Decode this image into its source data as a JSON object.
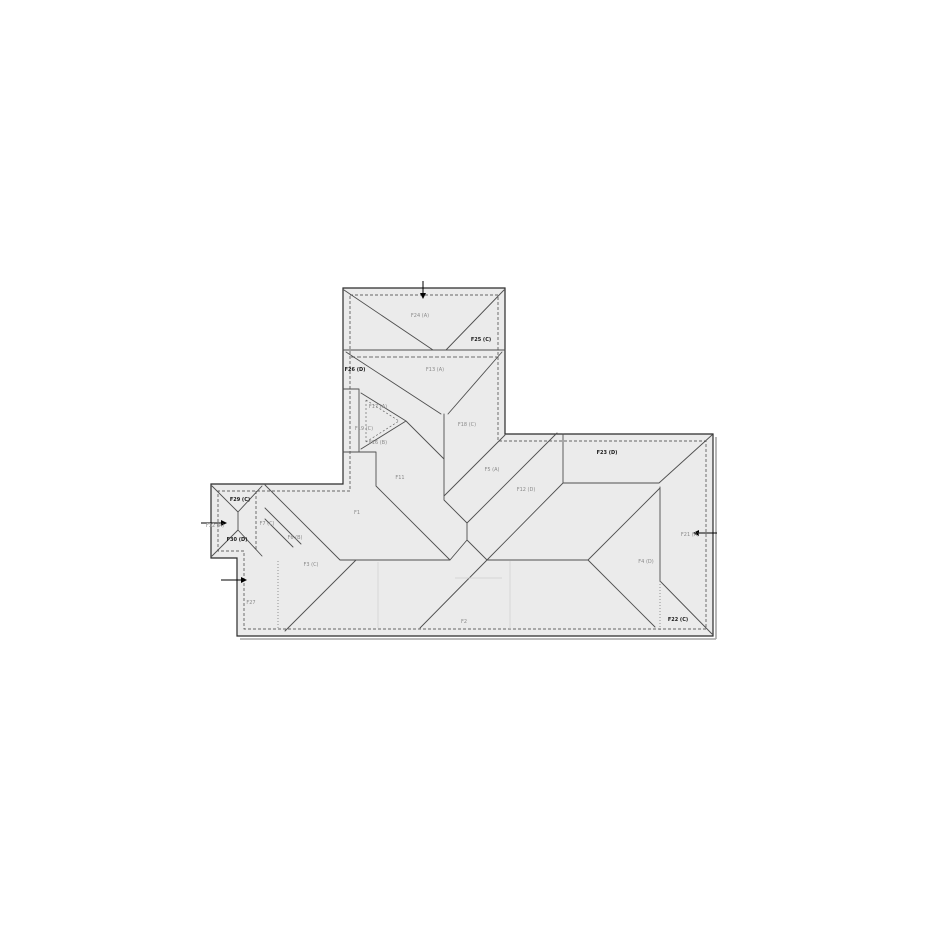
{
  "page": {
    "background": "#ffffff",
    "title": "roof-plan-drawing"
  },
  "drawing": {
    "kind": "roof plan",
    "colors": {
      "roof_fill": "#ebebeb",
      "outline": "#2b2b2b",
      "label_gray": "#8a8a8a",
      "label_bold": "#1a1a1a",
      "arrow": "#000000"
    },
    "labels": [
      {
        "id": "F24",
        "text": "F24 (A)",
        "x": 420,
        "y": 317,
        "bold": false
      },
      {
        "id": "F25",
        "text": "F25 (C)",
        "x": 481,
        "y": 341,
        "bold": true
      },
      {
        "id": "F26",
        "text": "F26 (D)",
        "x": 355,
        "y": 371,
        "bold": true
      },
      {
        "id": "F13",
        "text": "F13 (A)",
        "x": 435,
        "y": 371,
        "bold": false
      },
      {
        "id": "F17",
        "text": "F17 (A)",
        "x": 378,
        "y": 408,
        "bold": false
      },
      {
        "id": "F19",
        "text": "F19 (C)",
        "x": 364,
        "y": 430,
        "bold": false
      },
      {
        "id": "F16",
        "text": "F16 (B)",
        "x": 378,
        "y": 444,
        "bold": false
      },
      {
        "id": "F18",
        "text": "F18 (C)",
        "x": 467,
        "y": 426,
        "bold": false
      },
      {
        "id": "F11",
        "text": "F11",
        "x": 400,
        "y": 479,
        "bold": false
      },
      {
        "id": "F5",
        "text": "F5 (A)",
        "x": 492,
        "y": 471,
        "bold": false
      },
      {
        "id": "F12",
        "text": "F12 (D)",
        "x": 526,
        "y": 491,
        "bold": false
      },
      {
        "id": "F23",
        "text": "F23 (D)",
        "x": 607,
        "y": 454,
        "bold": true
      },
      {
        "id": "F21",
        "text": "F21 (A)",
        "x": 690,
        "y": 536,
        "bold": false
      },
      {
        "id": "F4",
        "text": "F4 (D)",
        "x": 646,
        "y": 563,
        "bold": false
      },
      {
        "id": "F22",
        "text": "F22 (C)",
        "x": 678,
        "y": 621,
        "bold": true
      },
      {
        "id": "F2",
        "text": "F2",
        "x": 464,
        "y": 623,
        "bold": false
      },
      {
        "id": "F3",
        "text": "F3 (C)",
        "x": 311,
        "y": 566,
        "bold": false
      },
      {
        "id": "F1",
        "text": "F1",
        "x": 357,
        "y": 514,
        "bold": false
      },
      {
        "id": "F7",
        "text": "F7 (C)",
        "x": 267,
        "y": 525,
        "bold": false
      },
      {
        "id": "F6",
        "text": "F6 (B)",
        "x": 295,
        "y": 539,
        "bold": false
      },
      {
        "id": "F29",
        "text": "F29 (C)",
        "x": 240,
        "y": 501,
        "bold": true
      },
      {
        "id": "F32",
        "text": "F32 (A)",
        "x": 215,
        "y": 527,
        "bold": false
      },
      {
        "id": "F30",
        "text": "F30 (D)",
        "x": 237,
        "y": 541,
        "bold": true
      },
      {
        "id": "F27",
        "text": "F27",
        "x": 251,
        "y": 604,
        "bold": false
      }
    ],
    "arrows": [
      {
        "name": "tower-top-arrow",
        "x": 423,
        "y": 281,
        "dir": "down",
        "len": 16
      },
      {
        "name": "bay-left-arrow",
        "x": 201,
        "y": 523,
        "dir": "right",
        "len": 24
      },
      {
        "name": "lower-left-arrow",
        "x": 221,
        "y": 580,
        "dir": "right",
        "len": 24
      },
      {
        "name": "right-wing-arrow",
        "x": 717,
        "y": 533,
        "dir": "left",
        "len": 22
      }
    ]
  }
}
